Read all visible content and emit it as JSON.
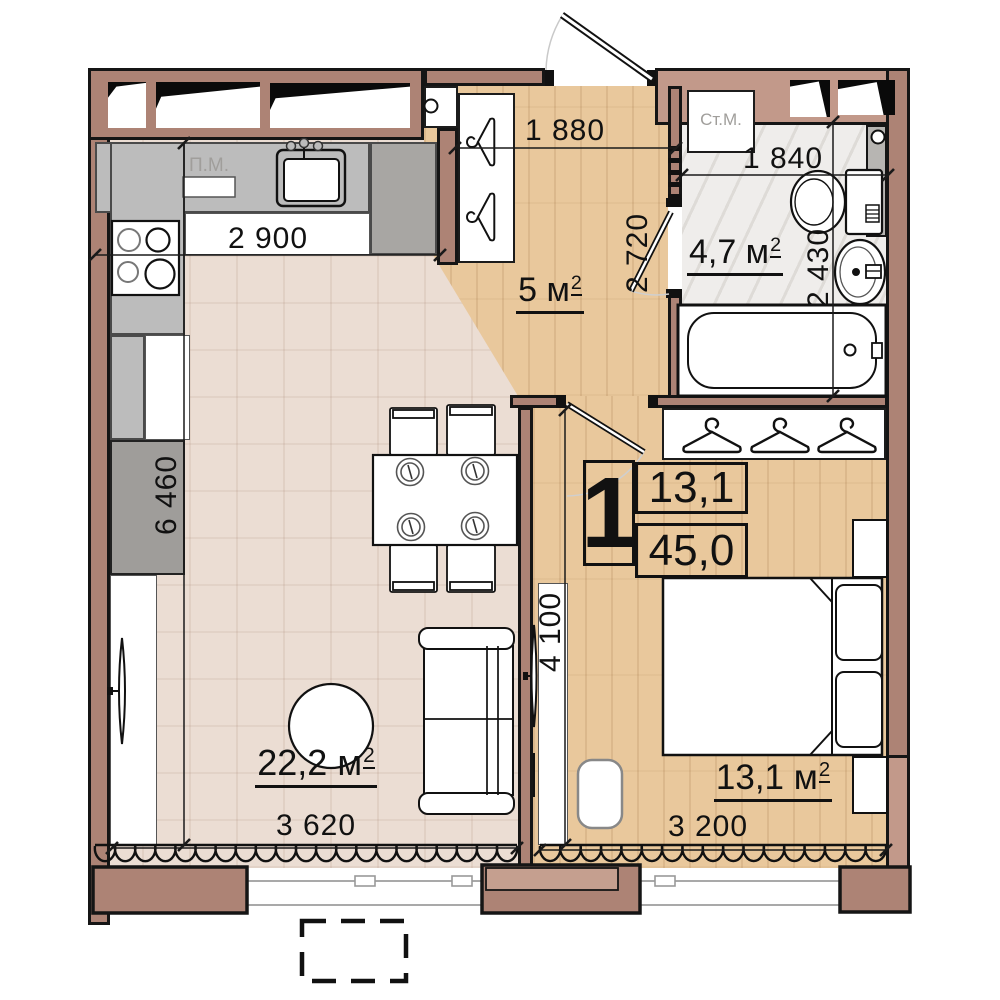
{
  "info_card": {
    "apartment_type": "1",
    "living_area": "13,1",
    "total_area": "45,0"
  },
  "rooms": {
    "hall": {
      "area": "5 м",
      "sup": "2"
    },
    "bathroom": {
      "area": "4,7 м",
      "sup": "2"
    },
    "living_kitchen": {
      "area": "22,2 м",
      "sup": "2"
    },
    "bedroom": {
      "area": "13,1 м",
      "sup": "2"
    }
  },
  "labels": {
    "dishwasher": "П.М.",
    "washing_machine": "Ст.М."
  },
  "dimensions": {
    "kitchen_width": "2 900",
    "hall_width": "1 880",
    "bathroom_width": "1 840",
    "hall_depth": "2 720",
    "bathroom_depth": "2 430",
    "living_depth": "6 460",
    "bedroom_depth": "4 100",
    "living_width": "3 620",
    "bedroom_width": "3 200"
  },
  "colors": {
    "wall_dark": "#ad8375",
    "wall_light": "#c2998a",
    "floor_tile": "#ebddd3",
    "floor_wood": "#e9c89c",
    "floor_marble": "#efedeb",
    "counter": "#bcbcbc",
    "counter_dark": "#a8a6a3",
    "outline": "#151515"
  }
}
